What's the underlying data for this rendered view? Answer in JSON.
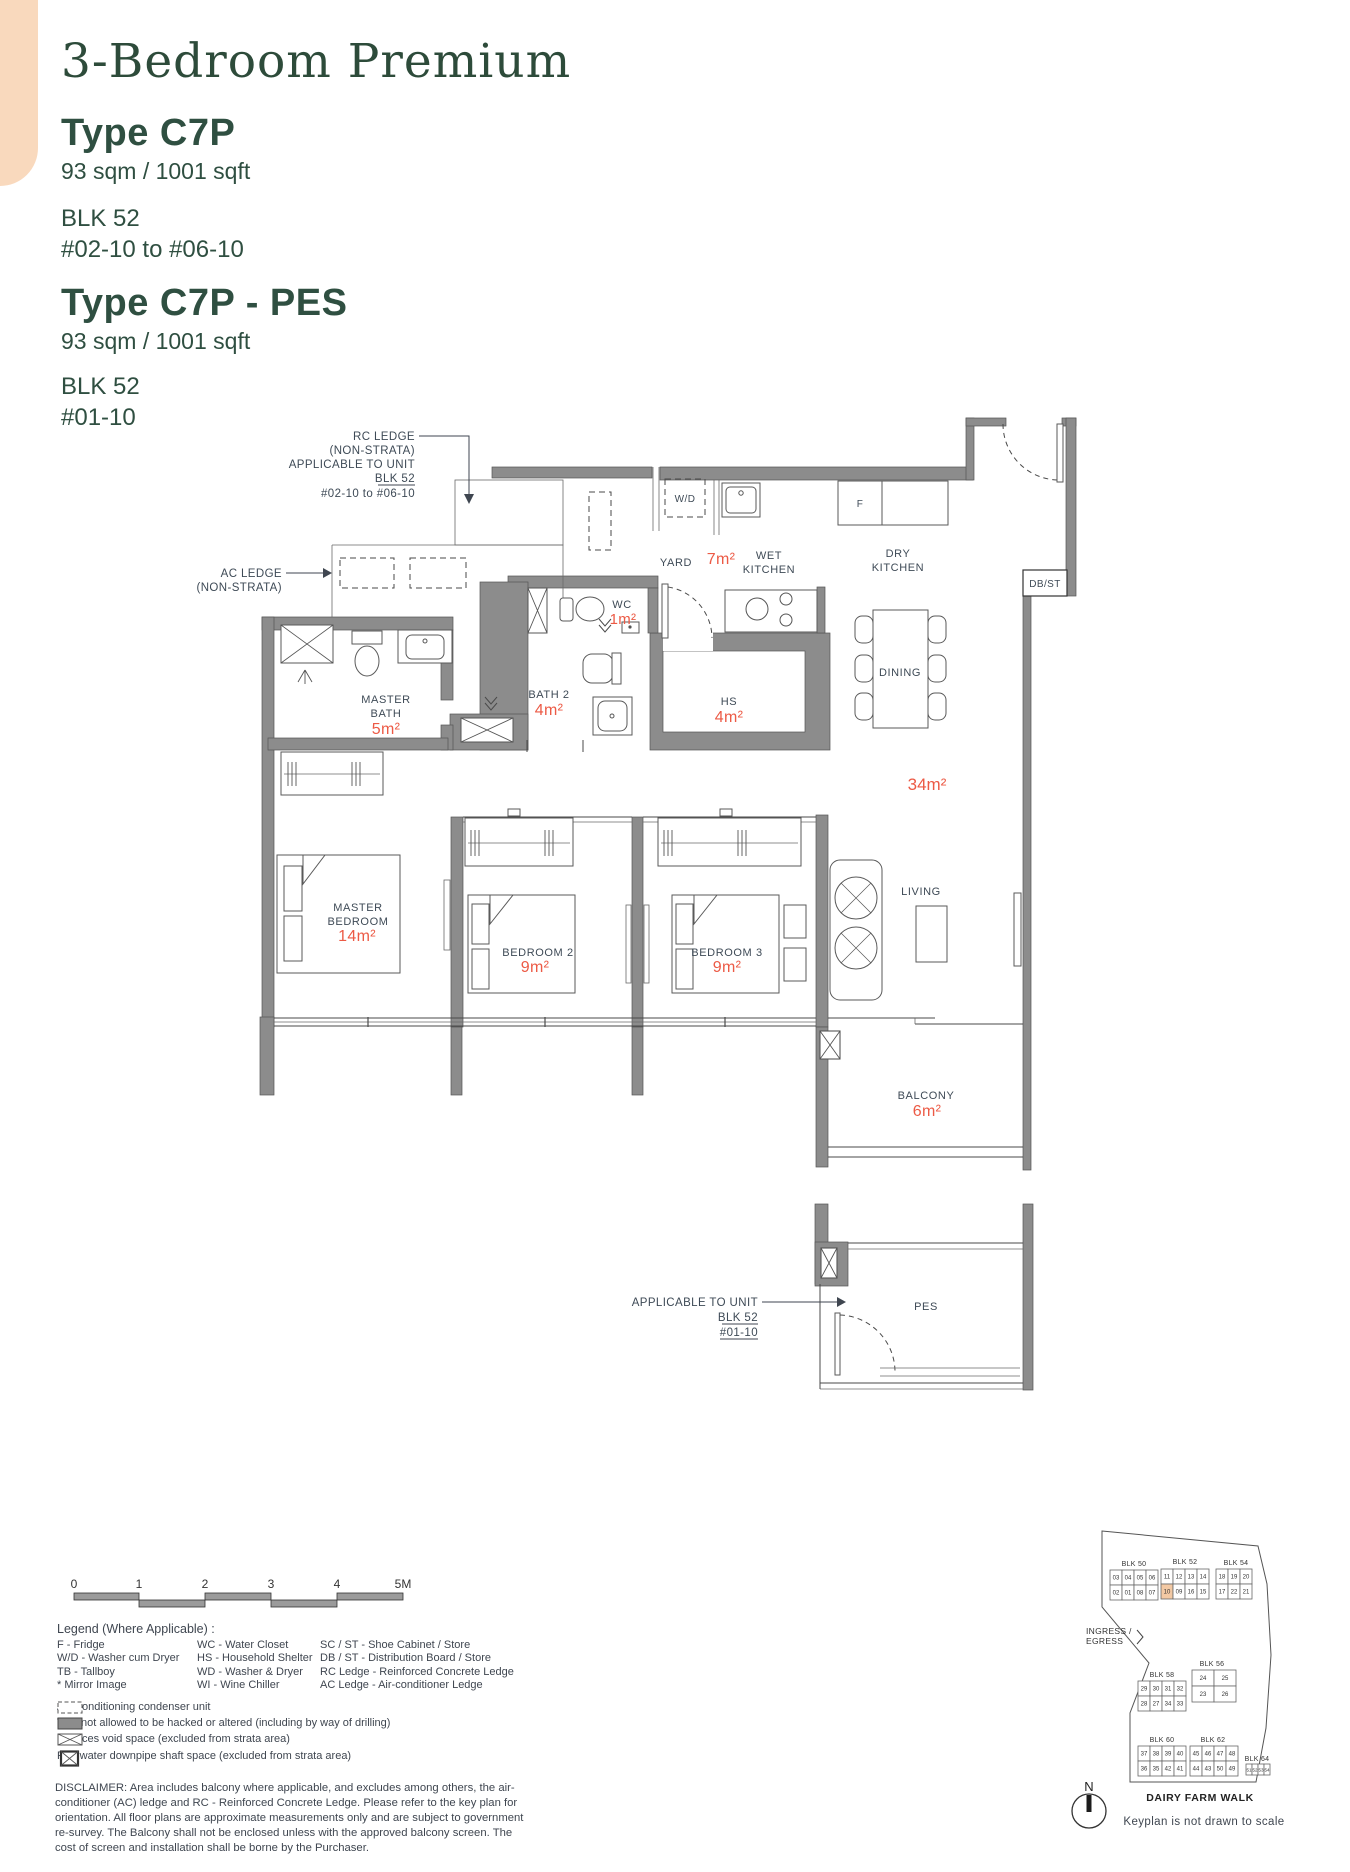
{
  "header": {
    "title": "3-Bedroom Premium",
    "types": [
      {
        "name": "Type C7P",
        "area": "93 sqm / 1001 sqft",
        "blk": "BLK 52",
        "units": "#02-10 to #06-10"
      },
      {
        "name": "Type C7P - PES",
        "area": "93 sqm / 1001 sqft",
        "blk": "BLK 52",
        "units": "#01-10"
      }
    ]
  },
  "plan": {
    "rc_note": {
      "l1": "RC LEDGE",
      "l2": "(NON-STRATA)",
      "l3": "APPLICABLE TO UNIT",
      "l4": "BLK 52",
      "l5": "#02-10 to #06-10"
    },
    "ac_note": {
      "l1": "AC LEDGE",
      "l2": "(NON-STRATA)"
    },
    "pes_note": {
      "l1": "APPLICABLE TO UNIT",
      "l2": "BLK 52",
      "l3": "#01-10"
    },
    "labels": {
      "yard": "YARD",
      "yard_area": "7m²",
      "wet1": "WET",
      "wet2": "KITCHEN",
      "dry1": "DRY",
      "dry2": "KITCHEN",
      "wc": "WC",
      "wc_area": "1m²",
      "mbath1": "MASTER",
      "mbath2": "BATH",
      "mbath_area": "5m²",
      "bath2": "BATH 2",
      "bath2_area": "4m²",
      "hs": "HS",
      "hs_area": "4m²",
      "dining": "DINING",
      "living": "LIVING",
      "living_area": "34m²",
      "mbr1": "MASTER",
      "mbr2": "BEDROOM",
      "mbr_area": "14m²",
      "br2": "BEDROOM 2",
      "br2_area": "9m²",
      "br3": "BEDROOM 3",
      "br3_area": "9m²",
      "balcony": "BALCONY",
      "balcony_area": "6m²",
      "pes": "PES",
      "wd": "W/D",
      "fridge": "F",
      "dbst": "DB/ST"
    }
  },
  "scalebar": {
    "ticks": [
      "0",
      "1",
      "2",
      "3",
      "4",
      "5M"
    ]
  },
  "legend": {
    "title": "Legend (Where Applicable) :",
    "col1": [
      "F - Fridge",
      "W/D - Washer cum Dryer",
      "TB - Tallboy",
      "* Mirror Image"
    ],
    "col2": [
      "WC - Water Closet",
      "HS - Household Shelter",
      "WD - Washer & Dryer",
      "WI - Wine Chiller"
    ],
    "col3": [
      "SC / ST - Shoe Cabinet / Store",
      "DB / ST - Distribution Board / Store",
      "RC Ledge - Reinforced Concrete Ledge",
      "AC Ledge - Air-conditioner Ledge"
    ],
    "symbols": [
      "Air-Conditioning condenser unit",
      "Wall not allowed to be hacked or altered (including by way of drilling)",
      "Services void space (excluded from strata area)",
      "Rainwater downpipe shaft space (excluded from strata area)"
    ]
  },
  "disclaimer": "DISCLAIMER: Area includes balcony where applicable, and excludes among others, the air-conditioner (AC) ledge and RC - Reinforced Concrete Ledge. Please refer to the key plan for orientation. All floor plans are approximate measurements only and are subject to government re-survey. The Balcony shall not be enclosed unless with the approved balcony screen. The cost of screen and installation shall be borne by the Purchaser.",
  "keyplan": {
    "ingress1": "INGRESS /",
    "ingress2": "EGRESS",
    "street": "DAIRY FARM WALK",
    "scale_note": "Keyplan is not drawn to scale",
    "north": "N",
    "highlight": {
      "block": 1,
      "row": 1,
      "col": 0
    },
    "blocks": [
      {
        "label": "BLK 50",
        "rows": [
          [
            "03",
            "04",
            "05",
            "06"
          ],
          [
            "02",
            "01",
            "08",
            "07"
          ]
        ]
      },
      {
        "label": "BLK 52",
        "rows": [
          [
            "11",
            "12",
            "13",
            "14"
          ],
          [
            "10",
            "09",
            "16",
            "15"
          ]
        ]
      },
      {
        "label": "BLK 54",
        "rows": [
          [
            "18",
            "19",
            "20"
          ],
          [
            "17",
            "22",
            "21"
          ]
        ]
      },
      {
        "label": "BLK 58",
        "rows": [
          [
            "29",
            "30",
            "31",
            "32"
          ],
          [
            "28",
            "27",
            "34",
            "33"
          ]
        ]
      },
      {
        "label": "BLK 56",
        "rows": [
          [
            "24",
            "25"
          ],
          [
            "23",
            "26"
          ]
        ]
      },
      {
        "label": "BLK 60",
        "rows": [
          [
            "37",
            "38",
            "39",
            "40"
          ],
          [
            "36",
            "35",
            "42",
            "41"
          ]
        ]
      },
      {
        "label": "BLK 62",
        "rows": [
          [
            "45",
            "46",
            "47",
            "48"
          ],
          [
            "44",
            "43",
            "50",
            "49"
          ]
        ]
      },
      {
        "label": "BLK 64",
        "rows": [
          [
            "51",
            "52",
            "53",
            "54"
          ]
        ]
      }
    ]
  },
  "colors": {
    "accent_peach": "#f9d9bd",
    "brand_green": "#2f4f41",
    "area_red": "#ec5a45",
    "wall_gray": "#8c8c8c"
  }
}
